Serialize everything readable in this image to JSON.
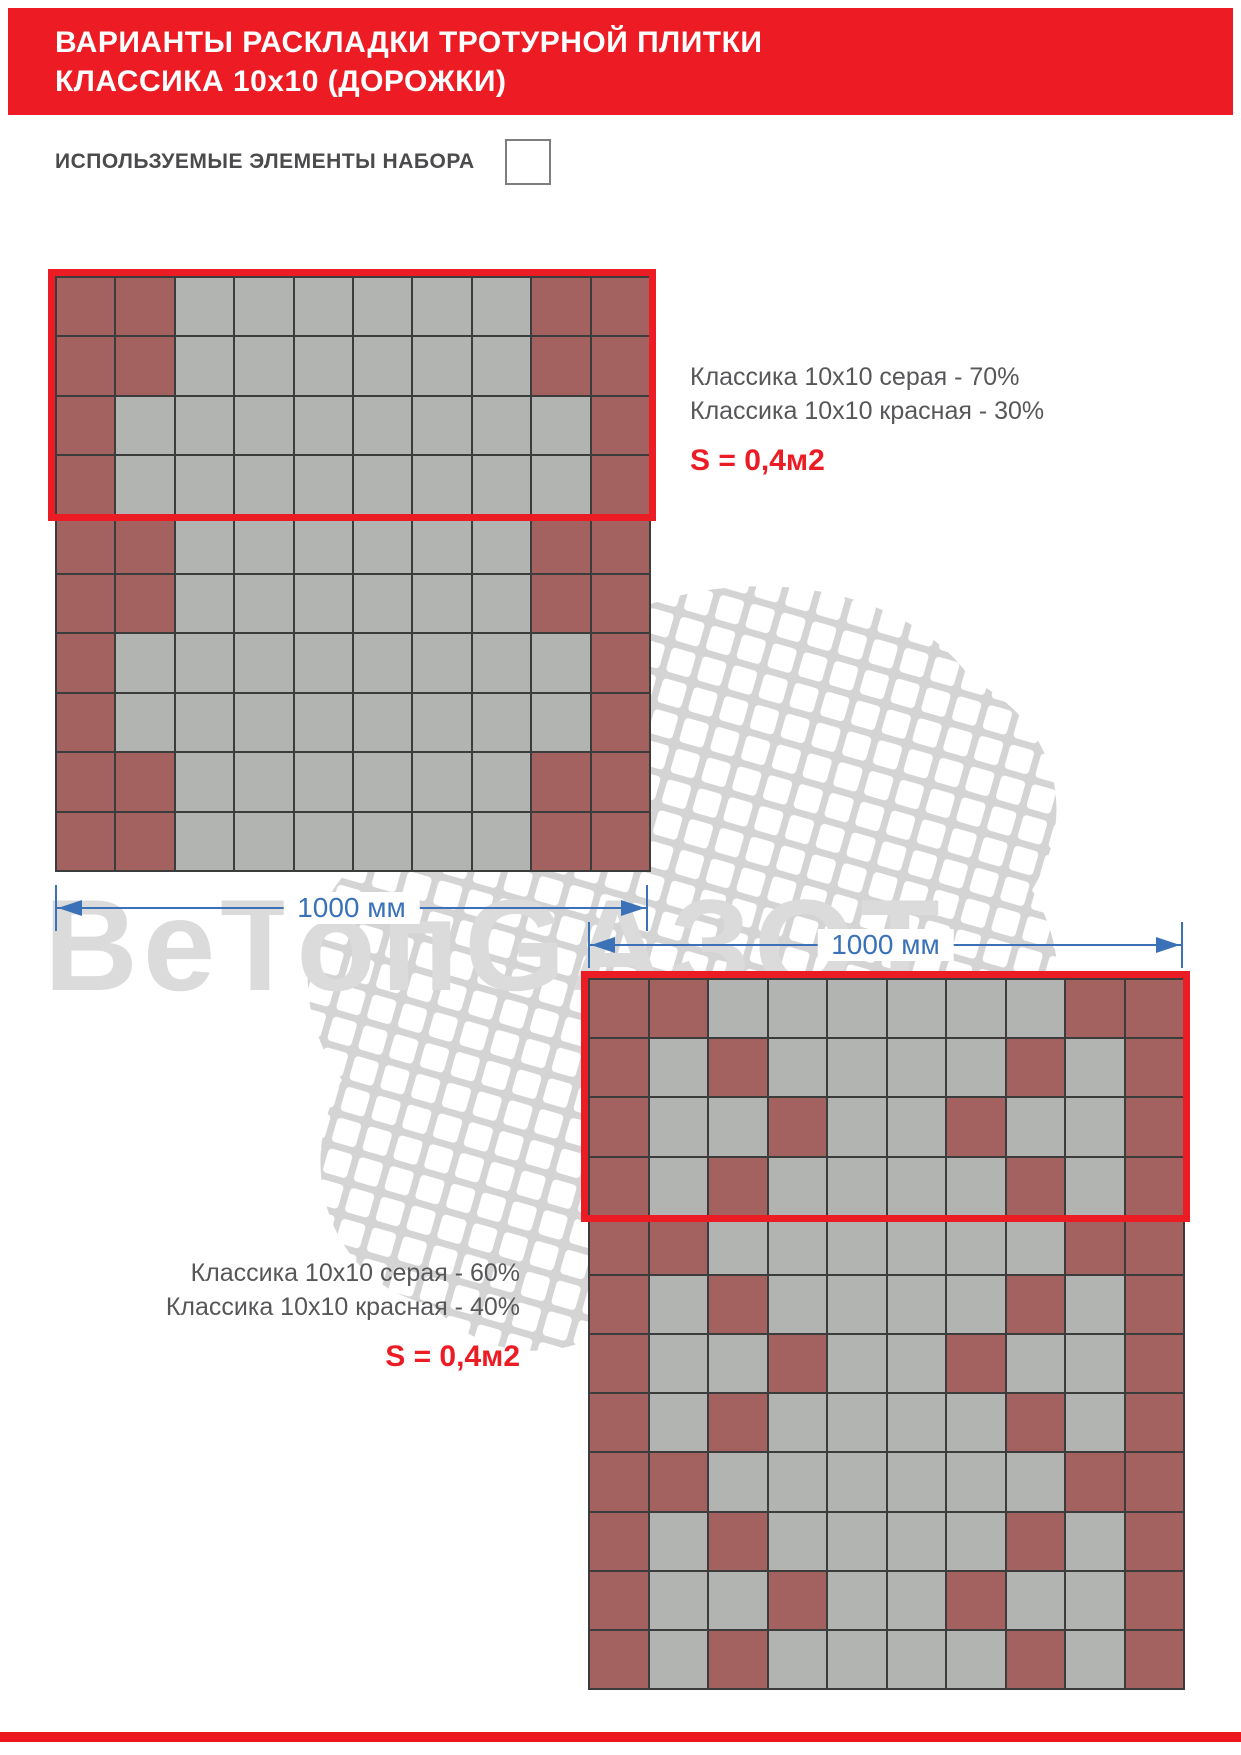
{
  "header": {
    "title_line1": "ВАРИАНТЫ РАСКЛАДКИ ТРОТУРНОЙ ПЛИТКИ",
    "title_line2": "КЛАССИКА 10x10 (ДОРОЖКИ)"
  },
  "elements": {
    "heading": "ИСПОЛЬЗУЕМЫЕ ЭЛЕМЕНТЫ НАБОРА"
  },
  "watermark": {
    "text": "ВеТопGАЗОТ"
  },
  "colors": {
    "banner_red": "#ed1c24",
    "outline_red": "#ec1c24",
    "tile_red": "#a36160",
    "tile_gray": "#b2b4b2",
    "dimension_blue": "#3b72b7",
    "text_gray": "#57575a"
  },
  "layouts": [
    {
      "legend_line1": "Классика 10x10 серая - 70%",
      "legend_line2": "Классика 10x10 красная - 30%",
      "area_label": "S = 0,4м2",
      "dimension_label": "1000 мм",
      "grid": {
        "cols": 10,
        "rows": 10,
        "highlight_rows": 4,
        "pattern": [
          "RRGGGGGGRR",
          "RRGGGGGGRR",
          "RGGGGGGGGR",
          "RGGGGGGGGR",
          "RRGGGGGGRR",
          "RRGGGGGGRR",
          "RGGGGGGGGR",
          "RGGGGGGGGR",
          "RRGGGGGGRR",
          "RRGGGGGGRR"
        ]
      }
    },
    {
      "legend_line1": "Классика 10x10 серая - 60%",
      "legend_line2": "Классика 10x10 красная - 40%",
      "area_label": "S = 0,4м2",
      "dimension_label": "1000 мм",
      "grid": {
        "cols": 10,
        "rows": 12,
        "highlight_rows": 4,
        "pattern": [
          "RRGGGGGGRR",
          "RGRGGGGRGR",
          "RGGRGGRGGR",
          "RGRGGGGRGR",
          "RRGGGGGGRR",
          "RGRGGGGRGR",
          "RGGRGGRGGR",
          "RGRGGGGRGR",
          "RRGGGGGGRR",
          "RGRGGGGRGR",
          "RGGRGGRGGR",
          "RGRGGGGRGR"
        ]
      }
    }
  ]
}
